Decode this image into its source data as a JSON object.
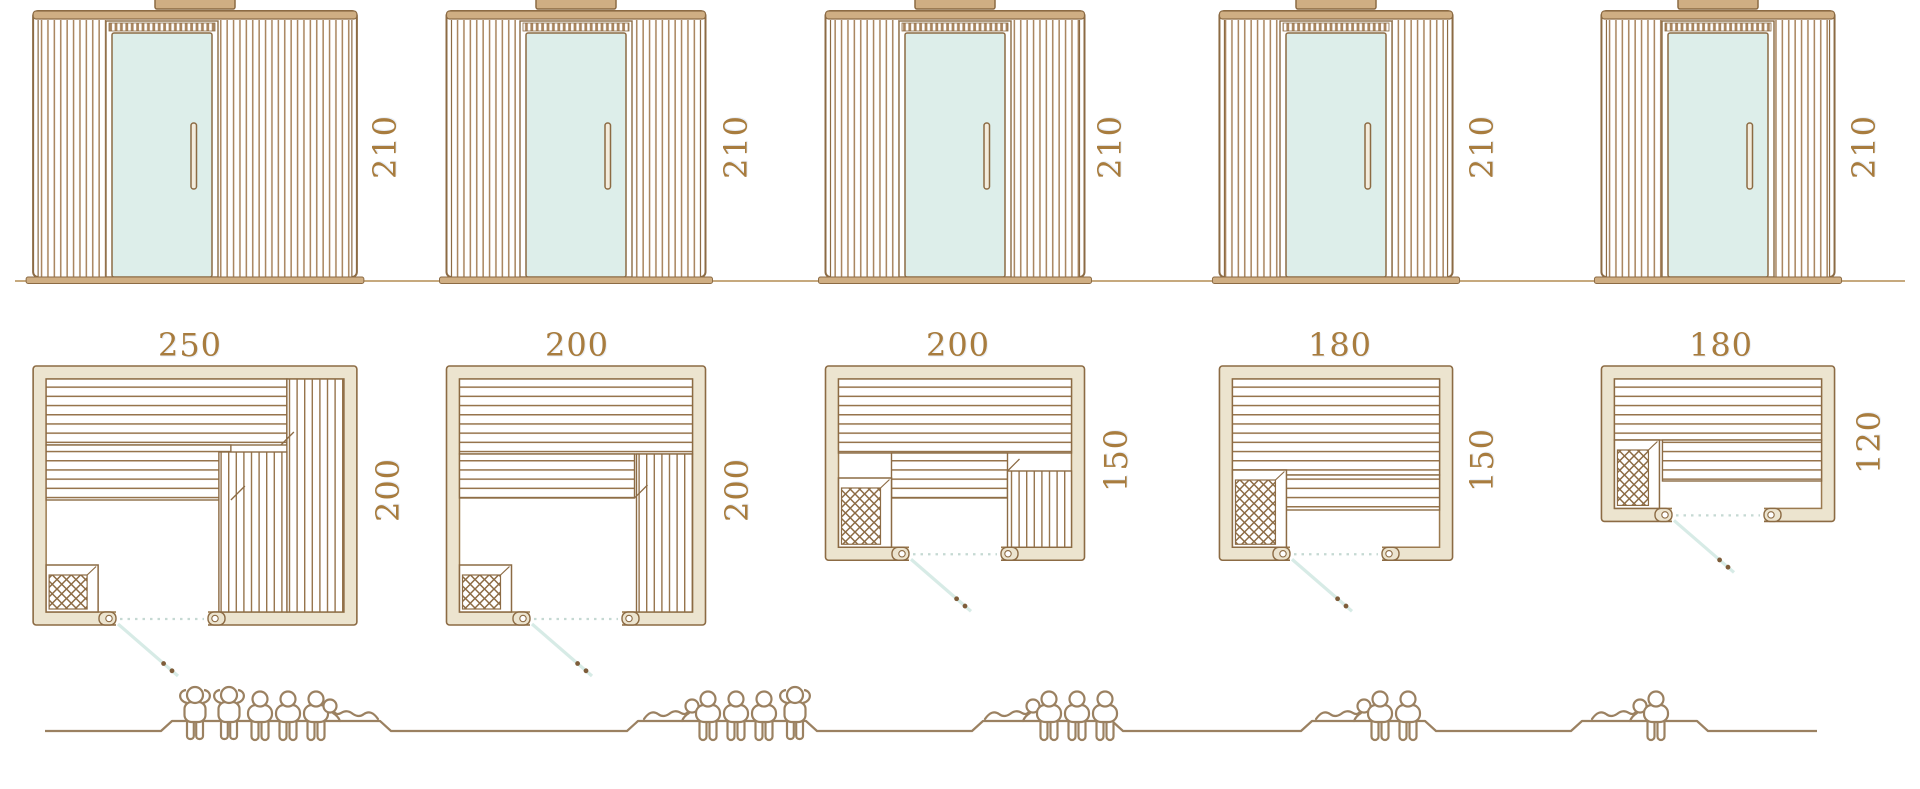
{
  "colors": {
    "outline": "#8c6b44",
    "inner_wall": "#9b7a4f",
    "wall_fill": "#ece4cf",
    "slat": "#a8845e",
    "bench_line": "#96744c",
    "beam_fill": "#cfae83",
    "glass": "#ddeeea",
    "door_swing": "#d7ebe6",
    "swing_dots": "#c5d9d3",
    "handle_dot": "#7e5d3a",
    "dimension_text": "#a87c3e",
    "people": "#9b8161",
    "backrest": "#a5815a",
    "ground": "#c6a97e",
    "handle_fill": "#f3ecdd"
  },
  "diagram": {
    "subject": "sauna-cabin-size-lineup",
    "views": [
      "front-elevation",
      "floor-plan",
      "seating-capacity"
    ]
  },
  "models": [
    {
      "name": "model-250x200",
      "height": "210",
      "width": "250",
      "depth": "200",
      "capacity": 6,
      "figures": [
        "standing",
        "standing",
        "sitting",
        "sitting",
        "sitting",
        "lying"
      ]
    },
    {
      "name": "model-200x200",
      "height": "210",
      "width": "200",
      "depth": "200",
      "capacity": 5,
      "figures": [
        "lying",
        "sitting",
        "sitting",
        "sitting",
        "standing"
      ]
    },
    {
      "name": "model-200x150",
      "height": "210",
      "width": "200",
      "depth": "150",
      "capacity": 4,
      "figures": [
        "lying",
        "sitting",
        "sitting",
        "sitting"
      ]
    },
    {
      "name": "model-180x150",
      "height": "210",
      "width": "180",
      "depth": "150",
      "capacity": 3,
      "figures": [
        "lying",
        "sitting",
        "sitting"
      ]
    },
    {
      "name": "model-180x120",
      "height": "210",
      "width": "180",
      "depth": "120",
      "capacity": 2,
      "figures": [
        "lying",
        "sitting"
      ]
    }
  ]
}
